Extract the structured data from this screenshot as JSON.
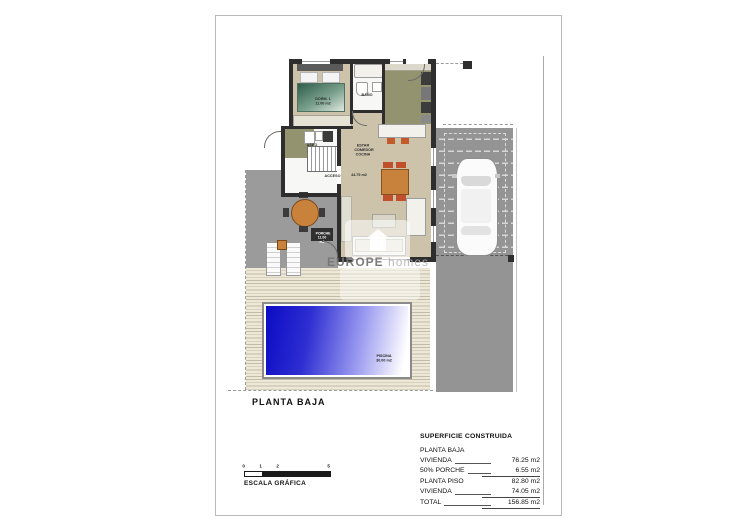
{
  "plan": {
    "title": "PLANTA BAJA",
    "watermark": {
      "brand": "EUROPE",
      "brand2": "homes"
    },
    "rooms": {
      "bedroom": {
        "name": "DORM. 1",
        "area": "11.00 m2"
      },
      "bathroom": {
        "name": "BAÑO"
      },
      "toilet": {
        "name": "ASEO"
      },
      "living": {
        "name": "ESTAR COMEDOR COCINA",
        "area": "44.75 m2"
      },
      "access": {
        "name": "ACCESO"
      },
      "porch": {
        "name": "PORCHE",
        "area": "11.00 m2"
      },
      "pool": {
        "name": "PISCINA",
        "area": "30.00 m2"
      }
    }
  },
  "scale_bar": {
    "ticks": [
      "0",
      "1",
      "2",
      "5"
    ],
    "label": "ESCALA GRÁFICA"
  },
  "summary": {
    "title": "SUPERFICIE CONSTRUIDA",
    "section1_heading": "PLANTA BAJA",
    "rows": [
      {
        "label": "VIVIENDA",
        "value": "76.25 m2"
      },
      {
        "label": "50% PORCHE",
        "value": "6.55 m2"
      }
    ],
    "subtotal": "82.80 m2",
    "section2_heading": "PLANTA PISO",
    "row2": {
      "label": "VIVIENDA",
      "value": "74.05 m2"
    },
    "total_label": "TOTAL",
    "total_value": "156.85 m2"
  },
  "colors": {
    "pool_blue": "#0b0bc4",
    "floor_beige": "#cdc3ab",
    "floor_olive": "#93946f",
    "terrace_gray": "#9b9b9b",
    "accent_orange": "#c8823c",
    "wall_dark": "#2e2e2e"
  }
}
